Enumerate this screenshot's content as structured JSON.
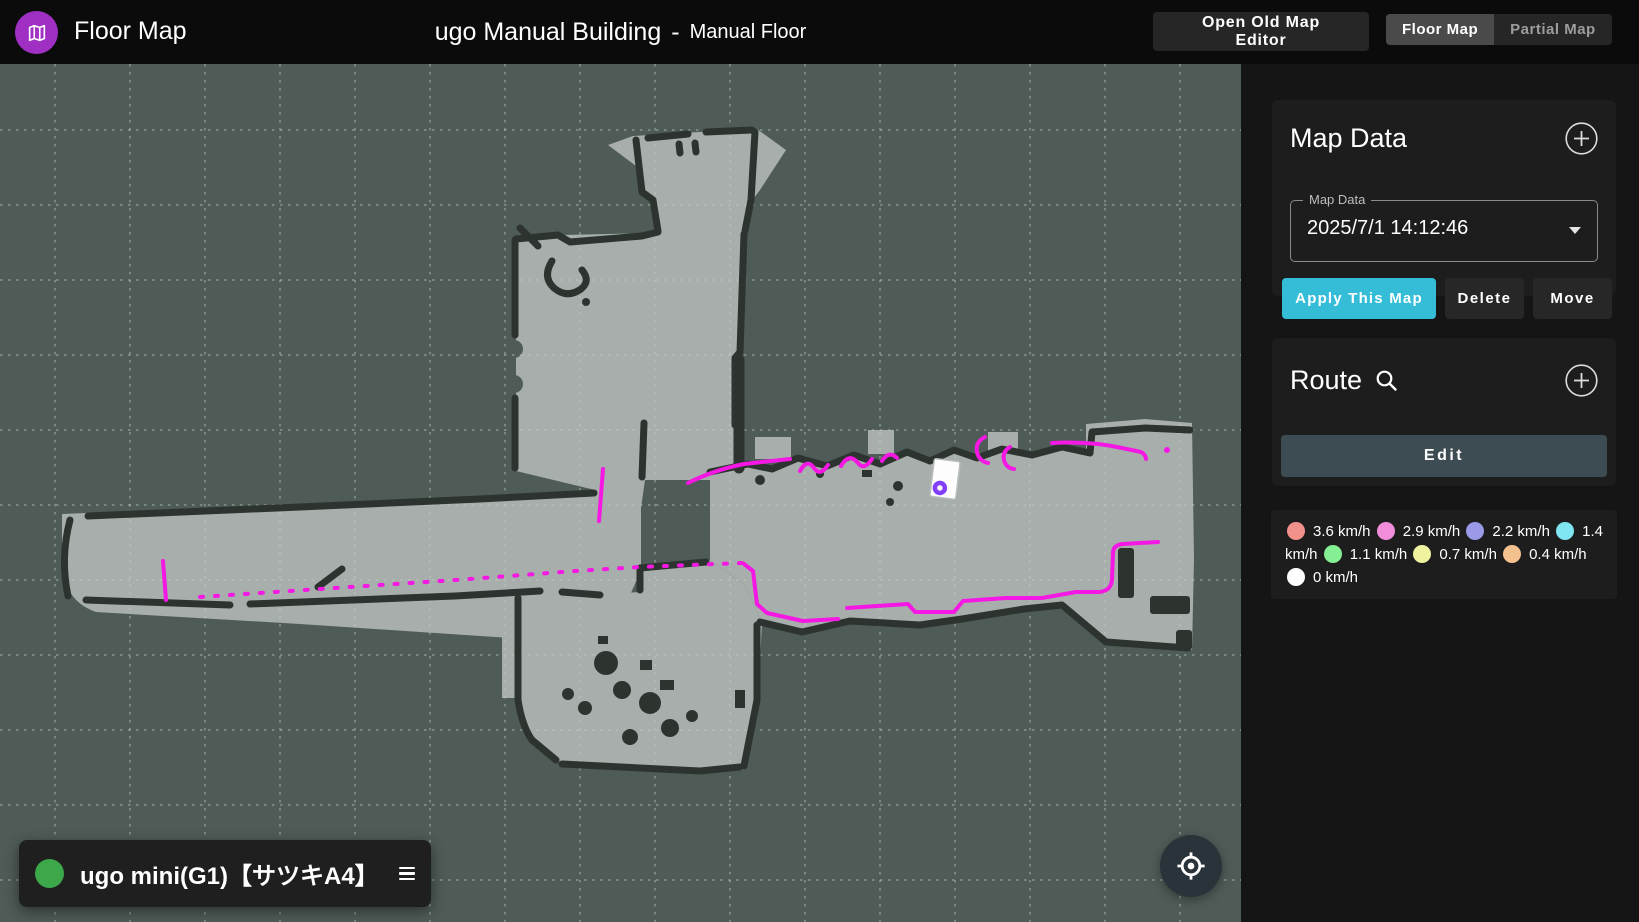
{
  "header": {
    "app_title": "Floor Map",
    "building_title": "ugo Manual Building",
    "title_separator": "-",
    "floor_title": "Manual Floor",
    "open_old_map_editor_label": "Open Old Map Editor",
    "toggle": {
      "floor_map_label": "Floor Map",
      "partial_map_label": "Partial Map"
    }
  },
  "map_data_panel": {
    "title": "Map Data",
    "select_label": "Map Data",
    "selected_value": "2025/7/1 14:12:46",
    "apply_label": "Apply This Map",
    "delete_label": "Delete",
    "move_label": "Move"
  },
  "route_panel": {
    "title": "Route",
    "edit_label": "Edit"
  },
  "legend": {
    "items": [
      {
        "label": "3.6 km/h",
        "color": "#f2918a"
      },
      {
        "label": "2.9 km/h",
        "color": "#f18ddb"
      },
      {
        "label": "2.2 km/h",
        "color": "#9b9ae8"
      },
      {
        "label": "1.4 km/h",
        "color": "#7fe5f0"
      },
      {
        "label": "1.1 km/h",
        "color": "#85ef93"
      },
      {
        "label": "0.7 km/h",
        "color": "#eff3a0"
      },
      {
        "label": "0.4 km/h",
        "color": "#f4c08e"
      },
      {
        "label": "0 km/h",
        "color": "#ffffff"
      }
    ]
  },
  "robot_status": {
    "name": "ugo mini(G1)【サツキA4】"
  },
  "icons": {
    "logo": "folded-map",
    "add": "circled-plus",
    "search": "magnifier",
    "dropdown": "caret-down",
    "menu": "hamburger",
    "locate": "crosshair-gps",
    "status": "green-dot"
  },
  "colors": {
    "accent_cyan": "#35bdd8",
    "route_magenta": "#f517e3",
    "robot_purple": "#8140f5",
    "status_green": "#3da84a",
    "map_background": "#4e5b57",
    "map_floor": "#a8aeab",
    "map_wall": "#2d3430"
  }
}
